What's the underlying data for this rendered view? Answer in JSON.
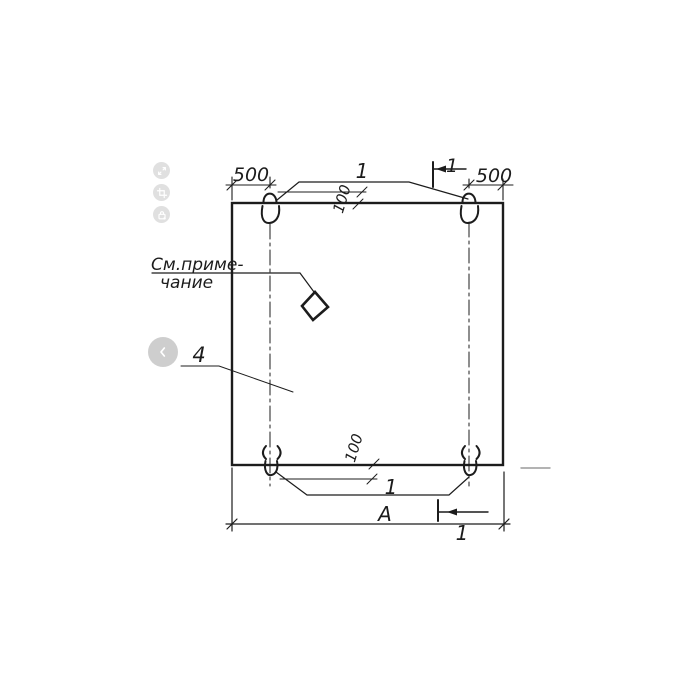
{
  "drawing": {
    "dimensions": {
      "top_left": "500",
      "top_right": "500",
      "edge_offset_top": "100",
      "edge_offset_bottom": "100",
      "overall_width": "A"
    },
    "callouts": {
      "loops_top": "1",
      "loops_bottom": "1",
      "panel_item": "4",
      "section_top": "1",
      "section_bottom": "1"
    },
    "note": {
      "line1": "См.приме-",
      "line2": "чание"
    },
    "colors": {
      "ink": "#1c1c1c",
      "faint_line": "#9a9a9a",
      "overlay_button": "#c7c7c7"
    }
  },
  "viewer": {
    "buttons": [
      {
        "id": "expand",
        "icon": "expand-icon"
      },
      {
        "id": "crop",
        "icon": "crop-icon"
      },
      {
        "id": "protect",
        "icon": "lock-icon"
      }
    ],
    "prev": {
      "icon": "chevron-left-icon"
    }
  }
}
